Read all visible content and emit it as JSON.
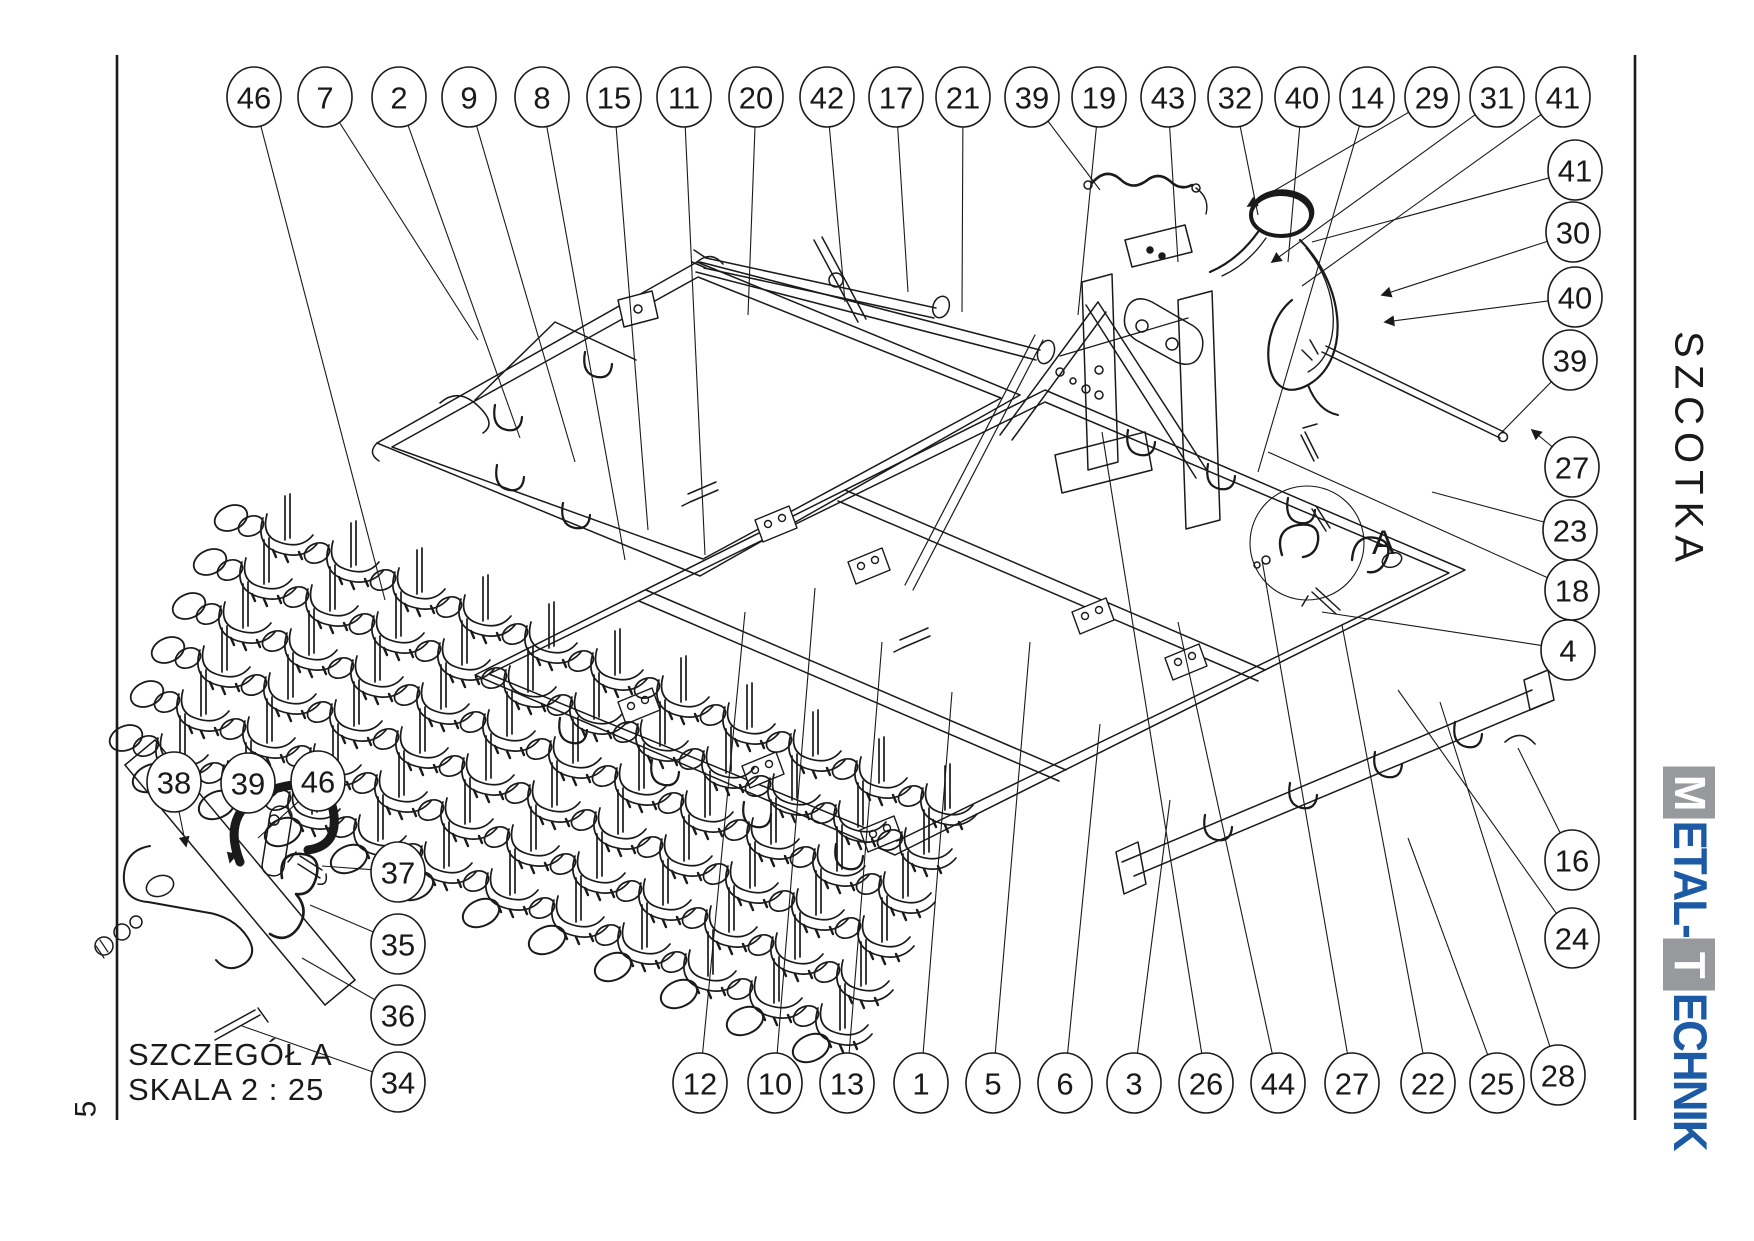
{
  "sheet": {
    "page_number": "5",
    "line_color": "#1a1a1a",
    "background": "#ffffff"
  },
  "side_title": "SZCOTKA",
  "detail_inset": {
    "title": "SZCZEGÓŁ A",
    "scale": "SKALA 2 : 25"
  },
  "detail_marker": "A",
  "logo": {
    "name": "METAL-TECHNIK",
    "blue": "#1c5aa5",
    "gray": "#97999c",
    "segments": [
      {
        "t": "M",
        "style": "box"
      },
      {
        "t": "ETAL-",
        "style": "blue"
      },
      {
        "t": "T",
        "style": "box"
      },
      {
        "t": "ECHNIK",
        "style": "blue"
      }
    ]
  },
  "balloons": {
    "rx": 27,
    "ry": 30,
    "font_size": 31,
    "groups": [
      {
        "name": "top-row",
        "items": [
          {
            "n": "46",
            "cx": 254,
            "cy": 97,
            "tx": 385,
            "ty": 600
          },
          {
            "n": "7",
            "cx": 325,
            "cy": 97,
            "tx": 478,
            "ty": 340
          },
          {
            "n": "2",
            "cx": 399,
            "cy": 97,
            "tx": 520,
            "ty": 438
          },
          {
            "n": "9",
            "cx": 469,
            "cy": 97,
            "tx": 575,
            "ty": 462
          },
          {
            "n": "8",
            "cx": 542,
            "cy": 97,
            "tx": 625,
            "ty": 560
          },
          {
            "n": "15",
            "cx": 614,
            "cy": 97,
            "tx": 648,
            "ty": 530
          },
          {
            "n": "11",
            "cx": 684,
            "cy": 97,
            "tx": 705,
            "ty": 555
          },
          {
            "n": "20",
            "cx": 756,
            "cy": 97,
            "tx": 748,
            "ty": 315
          },
          {
            "n": "42",
            "cx": 827,
            "cy": 97,
            "tx": 845,
            "ty": 302
          },
          {
            "n": "17",
            "cx": 896,
            "cy": 97,
            "tx": 908,
            "ty": 292
          },
          {
            "n": "21",
            "cx": 963,
            "cy": 97,
            "tx": 962,
            "ty": 312
          },
          {
            "n": "39",
            "cx": 1032,
            "cy": 97,
            "tx": 1100,
            "ty": 190
          },
          {
            "n": "19",
            "cx": 1099,
            "cy": 97,
            "tx": 1078,
            "ty": 315
          },
          {
            "n": "43",
            "cx": 1168,
            "cy": 97,
            "tx": 1178,
            "ty": 262
          },
          {
            "n": "32",
            "cx": 1235,
            "cy": 97,
            "tx": 1258,
            "ty": 215
          },
          {
            "n": "40",
            "cx": 1302,
            "cy": 97,
            "tx": 1288,
            "ty": 262
          },
          {
            "n": "14",
            "cx": 1367,
            "cy": 97,
            "tx": 1258,
            "ty": 472
          },
          {
            "n": "29",
            "cx": 1432,
            "cy": 97,
            "tx": 1248,
            "ty": 206,
            "arrow": true
          },
          {
            "n": "31",
            "cx": 1497,
            "cy": 97,
            "tx": 1272,
            "ty": 262,
            "arrow": true
          },
          {
            "n": "41",
            "cx": 1563,
            "cy": 97,
            "tx": 1302,
            "ty": 286
          }
        ]
      },
      {
        "name": "right-column",
        "items": [
          {
            "n": "41",
            "cx": 1575,
            "cy": 170,
            "tx": 1312,
            "ty": 242
          },
          {
            "n": "30",
            "cx": 1573,
            "cy": 232,
            "tx": 1382,
            "ty": 295,
            "arrow": true
          },
          {
            "n": "40",
            "cx": 1575,
            "cy": 297,
            "tx": 1385,
            "ty": 322,
            "arrow": true
          },
          {
            "n": "39",
            "cx": 1570,
            "cy": 360,
            "tx": 1498,
            "ty": 436
          },
          {
            "n": "27",
            "cx": 1572,
            "cy": 467,
            "tx": 1532,
            "ty": 430,
            "arrow": true
          },
          {
            "n": "23",
            "cx": 1570,
            "cy": 530,
            "tx": 1432,
            "ty": 492
          },
          {
            "n": "18",
            "cx": 1572,
            "cy": 590,
            "tx": 1268,
            "ty": 452
          },
          {
            "n": "4",
            "cx": 1568,
            "cy": 650,
            "tx": 1322,
            "ty": 612
          },
          {
            "n": "16",
            "cx": 1572,
            "cy": 860,
            "tx": 1518,
            "ty": 748
          },
          {
            "n": "24",
            "cx": 1572,
            "cy": 938,
            "tx": 1398,
            "ty": 690
          }
        ]
      },
      {
        "name": "bottom-row",
        "items": [
          {
            "n": "12",
            "cx": 700,
            "cy": 1083,
            "tx": 745,
            "ty": 612
          },
          {
            "n": "10",
            "cx": 775,
            "cy": 1083,
            "tx": 815,
            "ty": 588
          },
          {
            "n": "13",
            "cx": 847,
            "cy": 1083,
            "tx": 882,
            "ty": 642
          },
          {
            "n": "1",
            "cx": 921,
            "cy": 1083,
            "tx": 952,
            "ty": 692
          },
          {
            "n": "5",
            "cx": 993,
            "cy": 1083,
            "tx": 1030,
            "ty": 642
          },
          {
            "n": "6",
            "cx": 1065,
            "cy": 1083,
            "tx": 1100,
            "ty": 724
          },
          {
            "n": "3",
            "cx": 1134,
            "cy": 1083,
            "tx": 1170,
            "ty": 800
          },
          {
            "n": "26",
            "cx": 1206,
            "cy": 1083,
            "tx": 1102,
            "ty": 432
          },
          {
            "n": "44",
            "cx": 1278,
            "cy": 1083,
            "tx": 1178,
            "ty": 622
          },
          {
            "n": "27",
            "cx": 1352,
            "cy": 1083,
            "tx": 1262,
            "ty": 560
          },
          {
            "n": "22",
            "cx": 1428,
            "cy": 1083,
            "tx": 1342,
            "ty": 625
          },
          {
            "n": "25",
            "cx": 1497,
            "cy": 1083,
            "tx": 1408,
            "ty": 838
          },
          {
            "n": "28",
            "cx": 1558,
            "cy": 1075,
            "tx": 1440,
            "ty": 702
          }
        ]
      },
      {
        "name": "detail-inset",
        "items": [
          {
            "n": "38",
            "cx": 174,
            "cy": 782,
            "tx": 186,
            "ty": 846,
            "arrow": true
          },
          {
            "n": "39",
            "cx": 248,
            "cy": 783,
            "tx": 230,
            "ty": 862,
            "arrow": true
          },
          {
            "n": "46",
            "cx": 318,
            "cy": 781,
            "tx": 258,
            "ty": 838
          },
          {
            "n": "37",
            "cx": 398,
            "cy": 872,
            "tx": 322,
            "ty": 866
          },
          {
            "n": "35",
            "cx": 398,
            "cy": 944,
            "tx": 310,
            "ty": 905
          },
          {
            "n": "36",
            "cx": 398,
            "cy": 1015,
            "tx": 302,
            "ty": 958
          },
          {
            "n": "34",
            "cx": 398,
            "cy": 1082,
            "tx": 242,
            "ty": 1026
          }
        ]
      }
    ]
  }
}
